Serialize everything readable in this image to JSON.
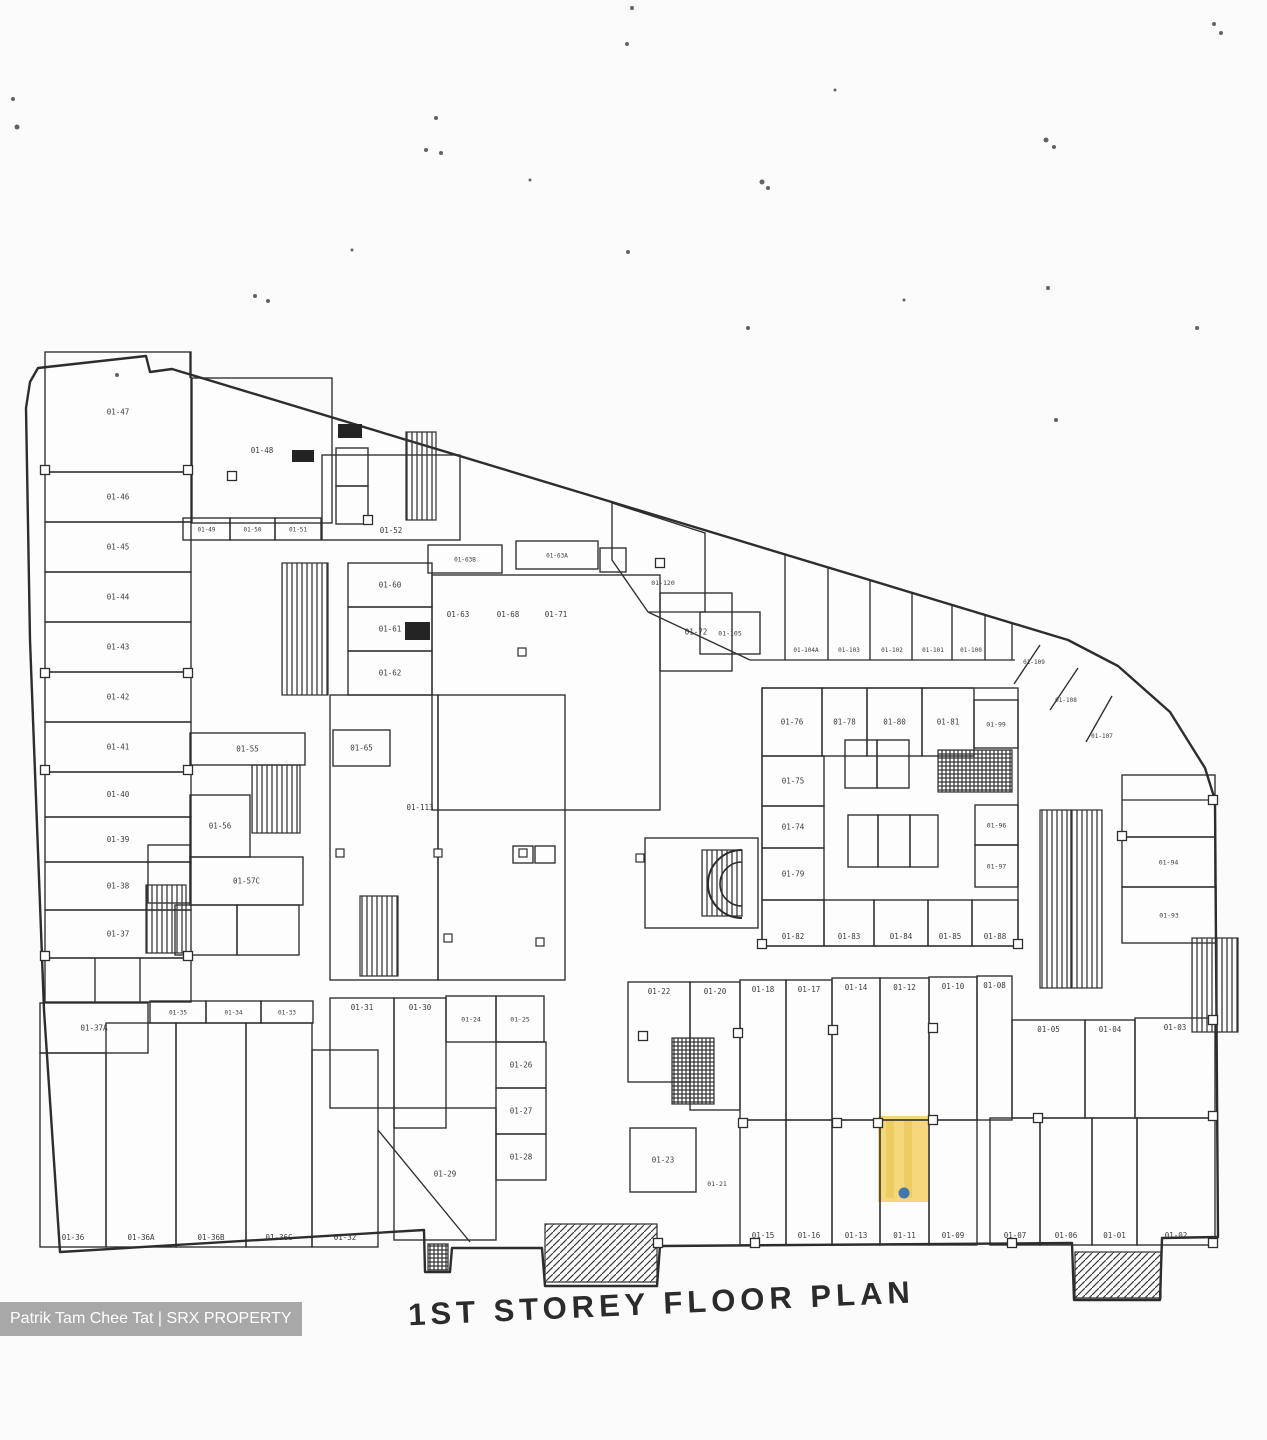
{
  "title": "1ST STOREY FLOOR PLAN",
  "watermark": "Patrik Tam Chee Tat | SRX PROPERTY",
  "highlighted_unit": {
    "unit": "01-11",
    "x": 878,
    "y": 1116,
    "w": 50,
    "h": 86,
    "stripes": [
      [
        886,
        1120,
        8,
        78
      ],
      [
        904,
        1120,
        8,
        78
      ]
    ],
    "marker": [
      904,
      1193,
      5.5
    ]
  },
  "colors": {
    "wall": "#2d2d2d",
    "label": "#2b2b2b",
    "paper": "#fdfdfd",
    "highlight_fill": "#f6d87c",
    "highlight_stripe": "#ecca60",
    "marker_blue": "#2f6db5",
    "watermark_bg": "#949494",
    "watermark_text": "#ffffff"
  },
  "outline": "38,368 146,356 150,372 172,369 1068,640 1118,666 1170,712 1205,768 1215,800 1218,1237 1162,1238 1160,1300 1074,1300 1072,1243 660,1246 657,1286 545,1286 542,1248 452,1248 450,1272 425,1272 424,1230 60,1252 44,1010 30,640 26,408 30,382",
  "rooms": [
    {
      "x": 45,
      "y": 352,
      "w": 146,
      "h": 120,
      "l": "01-47"
    },
    {
      "x": 45,
      "y": 472,
      "w": 146,
      "h": 50,
      "l": "01-46"
    },
    {
      "x": 45,
      "y": 522,
      "w": 146,
      "h": 50,
      "l": "01-45"
    },
    {
      "x": 45,
      "y": 572,
      "w": 146,
      "h": 50,
      "l": "01-44"
    },
    {
      "x": 45,
      "y": 622,
      "w": 146,
      "h": 50,
      "l": "01-43"
    },
    {
      "x": 45,
      "y": 672,
      "w": 146,
      "h": 50,
      "l": "01-42"
    },
    {
      "x": 45,
      "y": 722,
      "w": 146,
      "h": 50,
      "l": "01-41"
    },
    {
      "x": 45,
      "y": 772,
      "w": 146,
      "h": 45,
      "l": "01-40"
    },
    {
      "x": 45,
      "y": 817,
      "w": 146,
      "h": 45,
      "l": "01-39"
    },
    {
      "x": 45,
      "y": 862,
      "w": 146,
      "h": 48,
      "l": "01-38"
    },
    {
      "x": 45,
      "y": 910,
      "w": 146,
      "h": 48,
      "l": "01-37"
    },
    {
      "x": 45,
      "y": 958,
      "w": 146,
      "h": 44
    },
    {
      "x": 192,
      "y": 378,
      "w": 140,
      "h": 145,
      "l": "01-48"
    },
    {
      "x": 183,
      "y": 518,
      "w": 47,
      "h": 22,
      "l": "01-49",
      "s": 6
    },
    {
      "x": 230,
      "y": 518,
      "w": 45,
      "h": 22,
      "l": "01-50",
      "s": 6
    },
    {
      "x": 275,
      "y": 518,
      "w": 46,
      "h": 22,
      "l": "01-51",
      "s": 6
    },
    {
      "x": 322,
      "y": 455,
      "w": 138,
      "h": 85,
      "l": "01-52",
      "p": "b"
    },
    {
      "x": 336,
      "y": 448,
      "w": 32,
      "h": 38
    },
    {
      "x": 336,
      "y": 486,
      "w": 32,
      "h": 38
    },
    {
      "x": 600,
      "y": 548,
      "w": 26,
      "h": 24
    },
    {
      "x": 190,
      "y": 733,
      "w": 115,
      "h": 32,
      "l": "01-55"
    },
    {
      "x": 190,
      "y": 795,
      "w": 60,
      "h": 62,
      "l": "01-56"
    },
    {
      "x": 190,
      "y": 857,
      "w": 113,
      "h": 48,
      "l": "01-57C"
    },
    {
      "x": 148,
      "y": 845,
      "w": 42,
      "h": 58
    },
    {
      "x": 175,
      "y": 905,
      "w": 62,
      "h": 50
    },
    {
      "x": 237,
      "y": 905,
      "w": 62,
      "h": 50
    },
    {
      "x": 348,
      "y": 563,
      "w": 84,
      "h": 44,
      "l": "01-60"
    },
    {
      "x": 348,
      "y": 607,
      "w": 84,
      "h": 44,
      "l": "01-61"
    },
    {
      "x": 348,
      "y": 651,
      "w": 84,
      "h": 44,
      "l": "01-62"
    },
    {
      "x": 428,
      "y": 545,
      "w": 74,
      "h": 28,
      "l": "01-63B",
      "s": 6
    },
    {
      "x": 516,
      "y": 541,
      "w": 82,
      "h": 28,
      "l": "01-63A",
      "s": 6
    },
    {
      "x": 432,
      "y": 575,
      "w": 228,
      "h": 235
    },
    {
      "x": 660,
      "y": 593,
      "w": 72,
      "h": 78,
      "l": "01-72"
    },
    {
      "x": 333,
      "y": 730,
      "w": 57,
      "h": 36,
      "l": "01-65"
    },
    {
      "x": 330,
      "y": 695,
      "w": 108,
      "h": 285
    },
    {
      "x": 438,
      "y": 695,
      "w": 127,
      "h": 285
    },
    {
      "x": 700,
      "y": 612,
      "w": 60,
      "h": 42,
      "l": "01-105",
      "s": 6.5
    },
    {
      "x": 645,
      "y": 838,
      "w": 113,
      "h": 90
    },
    {
      "x": 513,
      "y": 846,
      "w": 20,
      "h": 17
    },
    {
      "x": 535,
      "y": 846,
      "w": 20,
      "h": 17
    },
    {
      "x": 762,
      "y": 688,
      "w": 256,
      "h": 258
    },
    {
      "x": 762,
      "y": 688,
      "w": 60,
      "h": 68,
      "l": "01-76"
    },
    {
      "x": 822,
      "y": 688,
      "w": 45,
      "h": 68,
      "l": "01-78"
    },
    {
      "x": 867,
      "y": 688,
      "w": 55,
      "h": 68,
      "l": "01-80"
    },
    {
      "x": 922,
      "y": 688,
      "w": 52,
      "h": 68,
      "l": "01-81"
    },
    {
      "x": 974,
      "y": 700,
      "w": 44,
      "h": 48,
      "l": "01-99",
      "s": 6.5
    },
    {
      "x": 762,
      "y": 756,
      "w": 62,
      "h": 50,
      "l": "01-75"
    },
    {
      "x": 762,
      "y": 806,
      "w": 62,
      "h": 42,
      "l": "01-74"
    },
    {
      "x": 762,
      "y": 848,
      "w": 62,
      "h": 52,
      "l": "01-79"
    },
    {
      "x": 845,
      "y": 740,
      "w": 32,
      "h": 48
    },
    {
      "x": 877,
      "y": 740,
      "w": 32,
      "h": 48
    },
    {
      "x": 848,
      "y": 815,
      "w": 30,
      "h": 52
    },
    {
      "x": 878,
      "y": 815,
      "w": 32,
      "h": 52
    },
    {
      "x": 910,
      "y": 815,
      "w": 28,
      "h": 52
    },
    {
      "x": 975,
      "y": 805,
      "w": 43,
      "h": 40,
      "l": "01-96",
      "s": 6.5
    },
    {
      "x": 975,
      "y": 845,
      "w": 43,
      "h": 42,
      "l": "01-97",
      "s": 6.5
    },
    {
      "x": 762,
      "y": 900,
      "w": 62,
      "h": 46,
      "l": "01-82",
      "p": "b"
    },
    {
      "x": 824,
      "y": 900,
      "w": 50,
      "h": 46,
      "l": "01-83",
      "p": "b"
    },
    {
      "x": 874,
      "y": 900,
      "w": 54,
      "h": 46,
      "l": "01-84",
      "p": "b"
    },
    {
      "x": 928,
      "y": 900,
      "w": 44,
      "h": 46,
      "l": "01-85",
      "p": "b"
    },
    {
      "x": 972,
      "y": 900,
      "w": 46,
      "h": 46,
      "l": "01-88",
      "p": "b"
    },
    {
      "x": 1122,
      "y": 775,
      "w": 93,
      "h": 62
    },
    {
      "x": 1122,
      "y": 837,
      "w": 93,
      "h": 50,
      "l": "01-94",
      "s": 6.5
    },
    {
      "x": 1122,
      "y": 887,
      "w": 94,
      "h": 56,
      "l": "01-93",
      "s": 6.5
    },
    {
      "x": 40,
      "y": 1003,
      "w": 108,
      "h": 50,
      "l": "01-37A"
    },
    {
      "x": 150,
      "y": 1001,
      "w": 56,
      "h": 22,
      "l": "01-35",
      "s": 6
    },
    {
      "x": 206,
      "y": 1001,
      "w": 55,
      "h": 22,
      "l": "01-34",
      "s": 6
    },
    {
      "x": 261,
      "y": 1001,
      "w": 52,
      "h": 22,
      "l": "01-33",
      "s": 6
    },
    {
      "x": 40,
      "y": 1053,
      "w": 66,
      "h": 194,
      "l": "01-36",
      "p": "b"
    },
    {
      "x": 106,
      "y": 1023,
      "w": 70,
      "h": 224,
      "l": "01-36A",
      "p": "b"
    },
    {
      "x": 176,
      "y": 1023,
      "w": 70,
      "h": 224,
      "l": "01-36B",
      "p": "b"
    },
    {
      "x": 246,
      "y": 1023,
      "w": 66,
      "h": 224,
      "l": "01-36C",
      "p": "b"
    },
    {
      "x": 312,
      "y": 1050,
      "w": 66,
      "h": 197,
      "l": "01-32",
      "p": "b"
    },
    {
      "x": 330,
      "y": 998,
      "w": 64,
      "h": 110,
      "l": "01-31",
      "p": "t"
    },
    {
      "x": 394,
      "y": 998,
      "w": 52,
      "h": 130,
      "l": "01-30",
      "p": "t"
    },
    {
      "x": 446,
      "y": 996,
      "w": 50,
      "h": 46,
      "l": "01-24",
      "s": 6.5
    },
    {
      "x": 496,
      "y": 996,
      "w": 48,
      "h": 46,
      "l": "01-25",
      "s": 6.5
    },
    {
      "x": 496,
      "y": 1042,
      "w": 50,
      "h": 46,
      "l": "01-26"
    },
    {
      "x": 496,
      "y": 1088,
      "w": 50,
      "h": 46,
      "l": "01-27"
    },
    {
      "x": 496,
      "y": 1134,
      "w": 50,
      "h": 46,
      "l": "01-28"
    },
    {
      "x": 394,
      "y": 1108,
      "w": 102,
      "h": 132,
      "l": "01-29"
    },
    {
      "x": 628,
      "y": 982,
      "w": 62,
      "h": 100,
      "l": "01-22",
      "p": "t"
    },
    {
      "x": 690,
      "y": 982,
      "w": 50,
      "h": 128,
      "l": "01-20",
      "p": "t"
    },
    {
      "x": 740,
      "y": 980,
      "w": 46,
      "h": 140,
      "l": "01-18",
      "p": "t"
    },
    {
      "x": 786,
      "y": 980,
      "w": 46,
      "h": 140,
      "l": "01-17",
      "p": "t"
    },
    {
      "x": 832,
      "y": 978,
      "w": 48,
      "h": 142,
      "l": "01-14",
      "p": "t"
    },
    {
      "x": 880,
      "y": 978,
      "w": 49,
      "h": 142,
      "l": "01-12",
      "p": "t"
    },
    {
      "x": 929,
      "y": 977,
      "w": 48,
      "h": 143,
      "l": "01-10",
      "p": "t"
    },
    {
      "x": 977,
      "y": 976,
      "w": 35,
      "h": 144,
      "l": "01-08",
      "p": "t"
    },
    {
      "x": 740,
      "y": 1120,
      "w": 46,
      "h": 125,
      "l": "01-15",
      "p": "b"
    },
    {
      "x": 786,
      "y": 1120,
      "w": 46,
      "h": 125,
      "l": "01-16",
      "p": "b"
    },
    {
      "x": 832,
      "y": 1120,
      "w": 48,
      "h": 125,
      "l": "01-13",
      "p": "b"
    },
    {
      "x": 880,
      "y": 1120,
      "w": 49,
      "h": 125,
      "l": "01-11",
      "p": "b"
    },
    {
      "x": 929,
      "y": 1120,
      "w": 48,
      "h": 125,
      "l": "01-09",
      "p": "b"
    },
    {
      "x": 630,
      "y": 1128,
      "w": 66,
      "h": 64,
      "l": "01-23"
    },
    {
      "x": 1012,
      "y": 1020,
      "w": 73,
      "h": 98,
      "l": "01-05",
      "p": "t"
    },
    {
      "x": 1085,
      "y": 1020,
      "w": 50,
      "h": 98,
      "l": "01-04",
      "p": "t"
    },
    {
      "x": 1135,
      "y": 1018,
      "w": 80,
      "h": 100,
      "l": "01-03",
      "p": "t"
    },
    {
      "x": 990,
      "y": 1118,
      "w": 50,
      "h": 127,
      "l": "01-07",
      "p": "b"
    },
    {
      "x": 1040,
      "y": 1118,
      "w": 52,
      "h": 127,
      "l": "01-06",
      "p": "b"
    },
    {
      "x": 1092,
      "y": 1118,
      "w": 45,
      "h": 127,
      "l": "01-01",
      "p": "b"
    },
    {
      "x": 1137,
      "y": 1118,
      "w": 78,
      "h": 127,
      "l": "01-02",
      "p": "b"
    }
  ],
  "polys": [
    {
      "pts": "612,503 705,533 705,612 648,612 612,560",
      "l": "01-120",
      "lx": 663,
      "ly": 585,
      "s": 6.5
    }
  ],
  "walls": [
    [
      750,
      660,
      1015,
      660
    ],
    [
      785,
      554,
      785,
      660
    ],
    [
      828,
      567,
      828,
      660
    ],
    [
      870,
      580,
      870,
      660
    ],
    [
      912,
      593,
      912,
      660
    ],
    [
      952,
      605,
      952,
      660
    ],
    [
      985,
      615,
      985,
      660
    ],
    [
      1012,
      623,
      1012,
      660
    ],
    [
      1040,
      645,
      1014,
      684
    ],
    [
      1078,
      668,
      1050,
      710
    ],
    [
      1112,
      696,
      1086,
      742
    ],
    [
      648,
      612,
      750,
      660
    ],
    [
      378,
      1130,
      470,
      1242
    ],
    [
      190,
      352,
      190,
      378
    ],
    [
      95,
      958,
      95,
      1002
    ],
    [
      140,
      958,
      140,
      1002
    ],
    [
      1215,
      800,
      1122,
      800
    ]
  ],
  "free_labels": [
    [
      458,
      617,
      "01-63"
    ],
    [
      508,
      617,
      "01-68"
    ],
    [
      556,
      617,
      "01-71"
    ],
    [
      420,
      810,
      "01-113"
    ],
    [
      806,
      652,
      "01-104A",
      6
    ],
    [
      849,
      652,
      "01-103",
      6
    ],
    [
      892,
      652,
      "01-102",
      6
    ],
    [
      933,
      652,
      "01-101",
      6
    ],
    [
      971,
      652,
      "01-100",
      6
    ],
    [
      1034,
      664,
      "01-109",
      6
    ],
    [
      1066,
      702,
      "01-108",
      6
    ],
    [
      1102,
      738,
      "01-107",
      6
    ],
    [
      717,
      1186,
      "01-21",
      6.5
    ]
  ],
  "hatches": [
    {
      "x": 406,
      "y": 432,
      "w": 30,
      "h": 88,
      "d": "v"
    },
    {
      "x": 146,
      "y": 885,
      "w": 40,
      "h": 68,
      "d": "v"
    },
    {
      "x": 360,
      "y": 896,
      "w": 38,
      "h": 80,
      "d": "v"
    },
    {
      "x": 282,
      "y": 563,
      "w": 46,
      "h": 132,
      "d": "v"
    },
    {
      "x": 252,
      "y": 765,
      "w": 48,
      "h": 68,
      "d": "v"
    },
    {
      "x": 938,
      "y": 750,
      "w": 74,
      "h": 42,
      "d": "x"
    },
    {
      "x": 672,
      "y": 1038,
      "w": 42,
      "h": 66,
      "d": "x"
    },
    {
      "x": 1040,
      "y": 810,
      "w": 31,
      "h": 178,
      "d": "v"
    },
    {
      "x": 1071,
      "y": 810,
      "w": 31,
      "h": 178,
      "d": "v"
    },
    {
      "x": 1192,
      "y": 938,
      "w": 46,
      "h": 94,
      "d": "v"
    },
    {
      "x": 545,
      "y": 1224,
      "w": 112,
      "h": 58,
      "d": "d"
    },
    {
      "x": 1075,
      "y": 1252,
      "w": 86,
      "h": 46,
      "d": "d"
    },
    {
      "x": 702,
      "y": 850,
      "w": 40,
      "h": 66,
      "d": "v"
    },
    {
      "x": 428,
      "y": 1244,
      "w": 20,
      "h": 26,
      "d": "x"
    }
  ],
  "solids": [
    [
      292,
      450,
      22,
      12
    ],
    [
      338,
      424,
      24,
      14
    ],
    [
      405,
      622,
      25,
      18
    ]
  ],
  "spiral": {
    "outer": "M 742,850 A 34,34 0 1 0 742,918",
    "inner": "M 742,862 A 22,22 0 1 0 742,906"
  },
  "nodes": [
    [
      45,
      470
    ],
    [
      188,
      470
    ],
    [
      45,
      673
    ],
    [
      188,
      673
    ],
    [
      45,
      770
    ],
    [
      188,
      770
    ],
    [
      45,
      956
    ],
    [
      188,
      956
    ],
    [
      232,
      476
    ],
    [
      368,
      520
    ],
    [
      660,
      563
    ],
    [
      643,
      1036
    ],
    [
      738,
      1033
    ],
    [
      833,
      1030
    ],
    [
      933,
      1028
    ],
    [
      743,
      1123
    ],
    [
      837,
      1123
    ],
    [
      933,
      1120
    ],
    [
      658,
      1243
    ],
    [
      755,
      1243
    ],
    [
      1012,
      1243
    ],
    [
      1213,
      1243
    ],
    [
      1213,
      1116
    ],
    [
      1213,
      1020
    ],
    [
      1038,
      1118
    ],
    [
      878,
      1123
    ],
    [
      762,
      944
    ],
    [
      1018,
      944
    ],
    [
      1122,
      836
    ],
    [
      1213,
      800
    ]
  ],
  "marks": [
    [
      340,
      853
    ],
    [
      438,
      853
    ],
    [
      523,
      853
    ],
    [
      640,
      858
    ],
    [
      448,
      938
    ],
    [
      540,
      942
    ],
    [
      522,
      652
    ]
  ],
  "specks": [
    [
      632,
      8,
      2
    ],
    [
      627,
      44,
      2
    ],
    [
      436,
      118,
      2
    ],
    [
      426,
      150,
      2
    ],
    [
      441,
      153,
      2
    ],
    [
      255,
      296,
      2
    ],
    [
      268,
      301,
      2
    ],
    [
      762,
      182,
      2.5
    ],
    [
      768,
      188,
      2
    ],
    [
      1046,
      140,
      2.5
    ],
    [
      1054,
      147,
      2
    ],
    [
      1048,
      288,
      2
    ],
    [
      1214,
      24,
      2
    ],
    [
      1221,
      33,
      2
    ],
    [
      13,
      99,
      2
    ],
    [
      17,
      127,
      2.5
    ],
    [
      1197,
      328,
      2
    ],
    [
      748,
      328,
      2
    ],
    [
      628,
      252,
      2
    ],
    [
      904,
      300,
      1.5
    ],
    [
      1056,
      420,
      2
    ],
    [
      352,
      250,
      1.5
    ],
    [
      117,
      375,
      2
    ],
    [
      530,
      180,
      1.5
    ],
    [
      835,
      90,
      1.5
    ]
  ]
}
